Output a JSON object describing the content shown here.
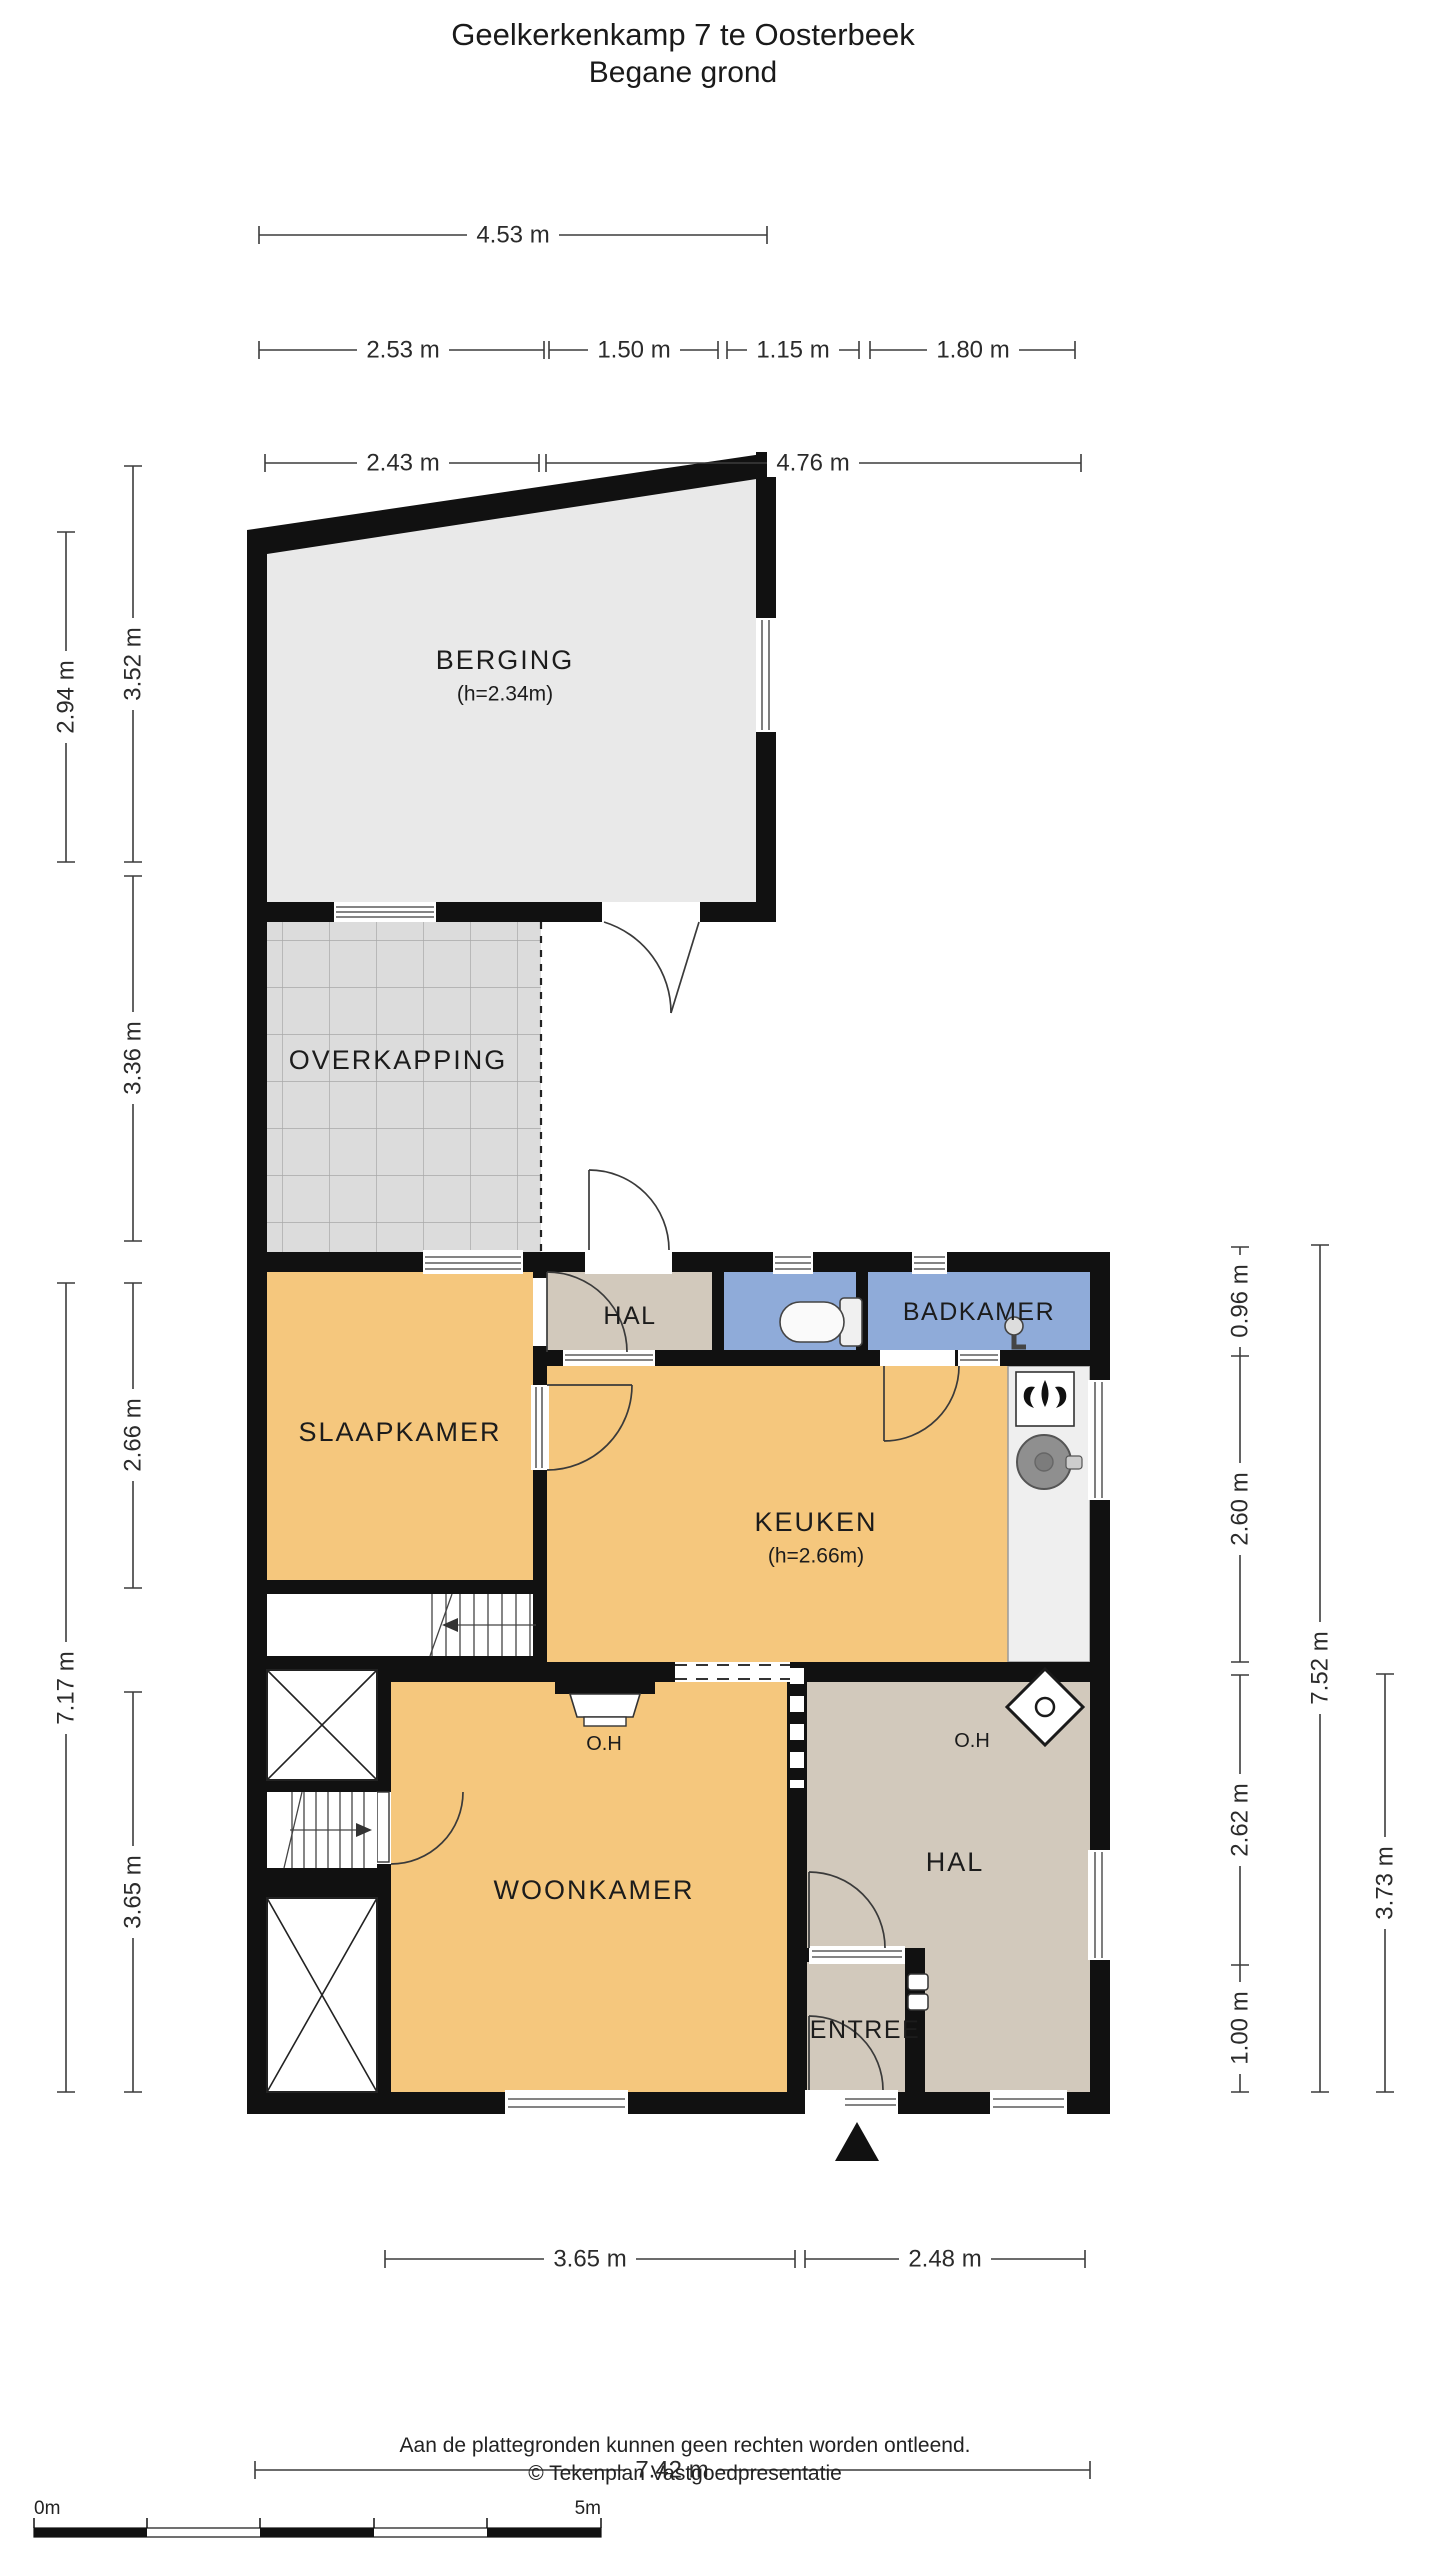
{
  "title": {
    "line1": "Geelkerkenkamp 7 te Oosterbeek",
    "line2": "Begane grond"
  },
  "rooms": {
    "berging": "BERGING",
    "berging_h": "(h=2.34m)",
    "overkapping": "OVERKAPPING",
    "hal_boven": "HAL",
    "badkamer": "BADKAMER",
    "slaapkamer": "SLAAPKAMER",
    "keuken": "KEUKEN",
    "keuken_h": "(h=2.66m)",
    "woonkamer": "WOONKAMER",
    "hal_beneden": "HAL",
    "entree": "ENTREE",
    "oh_woonkamer": "O.H",
    "oh_hal": "O.H"
  },
  "dims": {
    "t1": "4.53 m",
    "t2": "2.53 m",
    "t3": "1.50 m",
    "t4": "1.15 m",
    "t5": "1.80 m",
    "t6": "2.43 m",
    "t7": "4.76 m",
    "l1": "2.94 m",
    "l2": "3.52 m",
    "l3": "3.36 m",
    "l4": "2.66 m",
    "l5": "3.65 m",
    "l6": "7.17 m",
    "r1": "0.96 m",
    "r2": "2.60 m",
    "r3": "2.62 m",
    "r4": "1.00 m",
    "r5": "7.52 m",
    "r6": "3.73 m",
    "b1": "3.65 m",
    "b2": "2.48 m",
    "b3": "7.42 m"
  },
  "footer": {
    "disclaimer": "Aan de plattegronden kunnen geen rechten worden ontleend.",
    "copyright": "© Tekenplan Vastgoedpresentatie"
  },
  "scalebar": {
    "start": "0m",
    "end": "5m"
  },
  "icons": {
    "north_arrow": "triangle-up",
    "stove": "gas-flame",
    "sink": "round-basin",
    "shower": "shower-mixer",
    "toilet": "toilet-top-view",
    "fireplace": "open-haard-mantel",
    "stairs": "stair-run-with-arrow",
    "closet": "crossed-box"
  },
  "colors": {
    "room_orange": "#F5C77D",
    "room_taupe": "#D2C9BC",
    "room_blue": "#8FABD9",
    "berging_gray": "#E9E9E9",
    "tile_gray": "#DCDCDC",
    "tile_line": "#A8A8A8",
    "wall_black": "#111111",
    "dim_line": "#3C3C3C"
  }
}
